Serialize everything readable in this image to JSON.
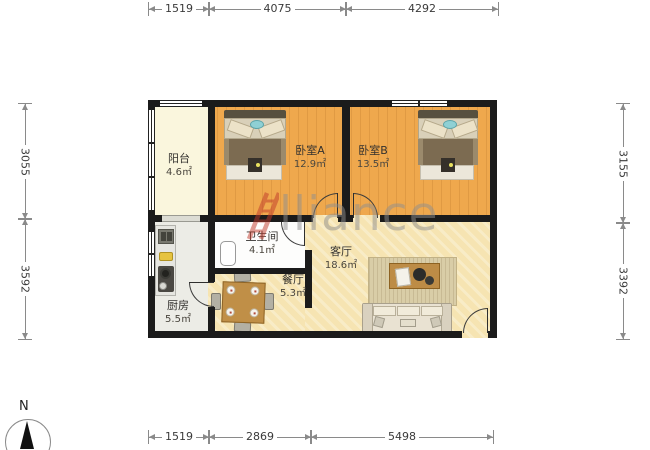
{
  "plan": {
    "rooms": [
      {
        "name": "阳台",
        "area": "4.6㎡"
      },
      {
        "name": "卧室A",
        "area": "12.9㎡"
      },
      {
        "name": "卧室B",
        "area": "13.5㎡"
      },
      {
        "name": "卫生间",
        "area": "4.1㎡"
      },
      {
        "name": "客厅",
        "area": "18.6㎡"
      },
      {
        "name": "餐厅",
        "area": "5.3㎡"
      },
      {
        "name": "厨房",
        "area": "5.5㎡"
      }
    ]
  },
  "dimensions": {
    "top": [
      "1519",
      "4075",
      "4292"
    ],
    "bottom": [
      "1519",
      "2869",
      "5498"
    ],
    "left": [
      "3055",
      "3592"
    ],
    "right": [
      "3155",
      "3392"
    ]
  },
  "compass": {
    "north_label": "N"
  },
  "watermark": {
    "brand": "Alliance",
    "visible_text": "lliance"
  },
  "colors": {
    "wall": "#1b1b1b",
    "bedroom_floor": "#efa84d",
    "living_floor": "#f6e4b2",
    "balcony_floor": "#faf6dd",
    "kitchen_floor": "#ececE6",
    "bathroom_floor": "#fdfdfc",
    "watermark_red": "#c0392b",
    "watermark_gray": "#8f8f8f"
  }
}
